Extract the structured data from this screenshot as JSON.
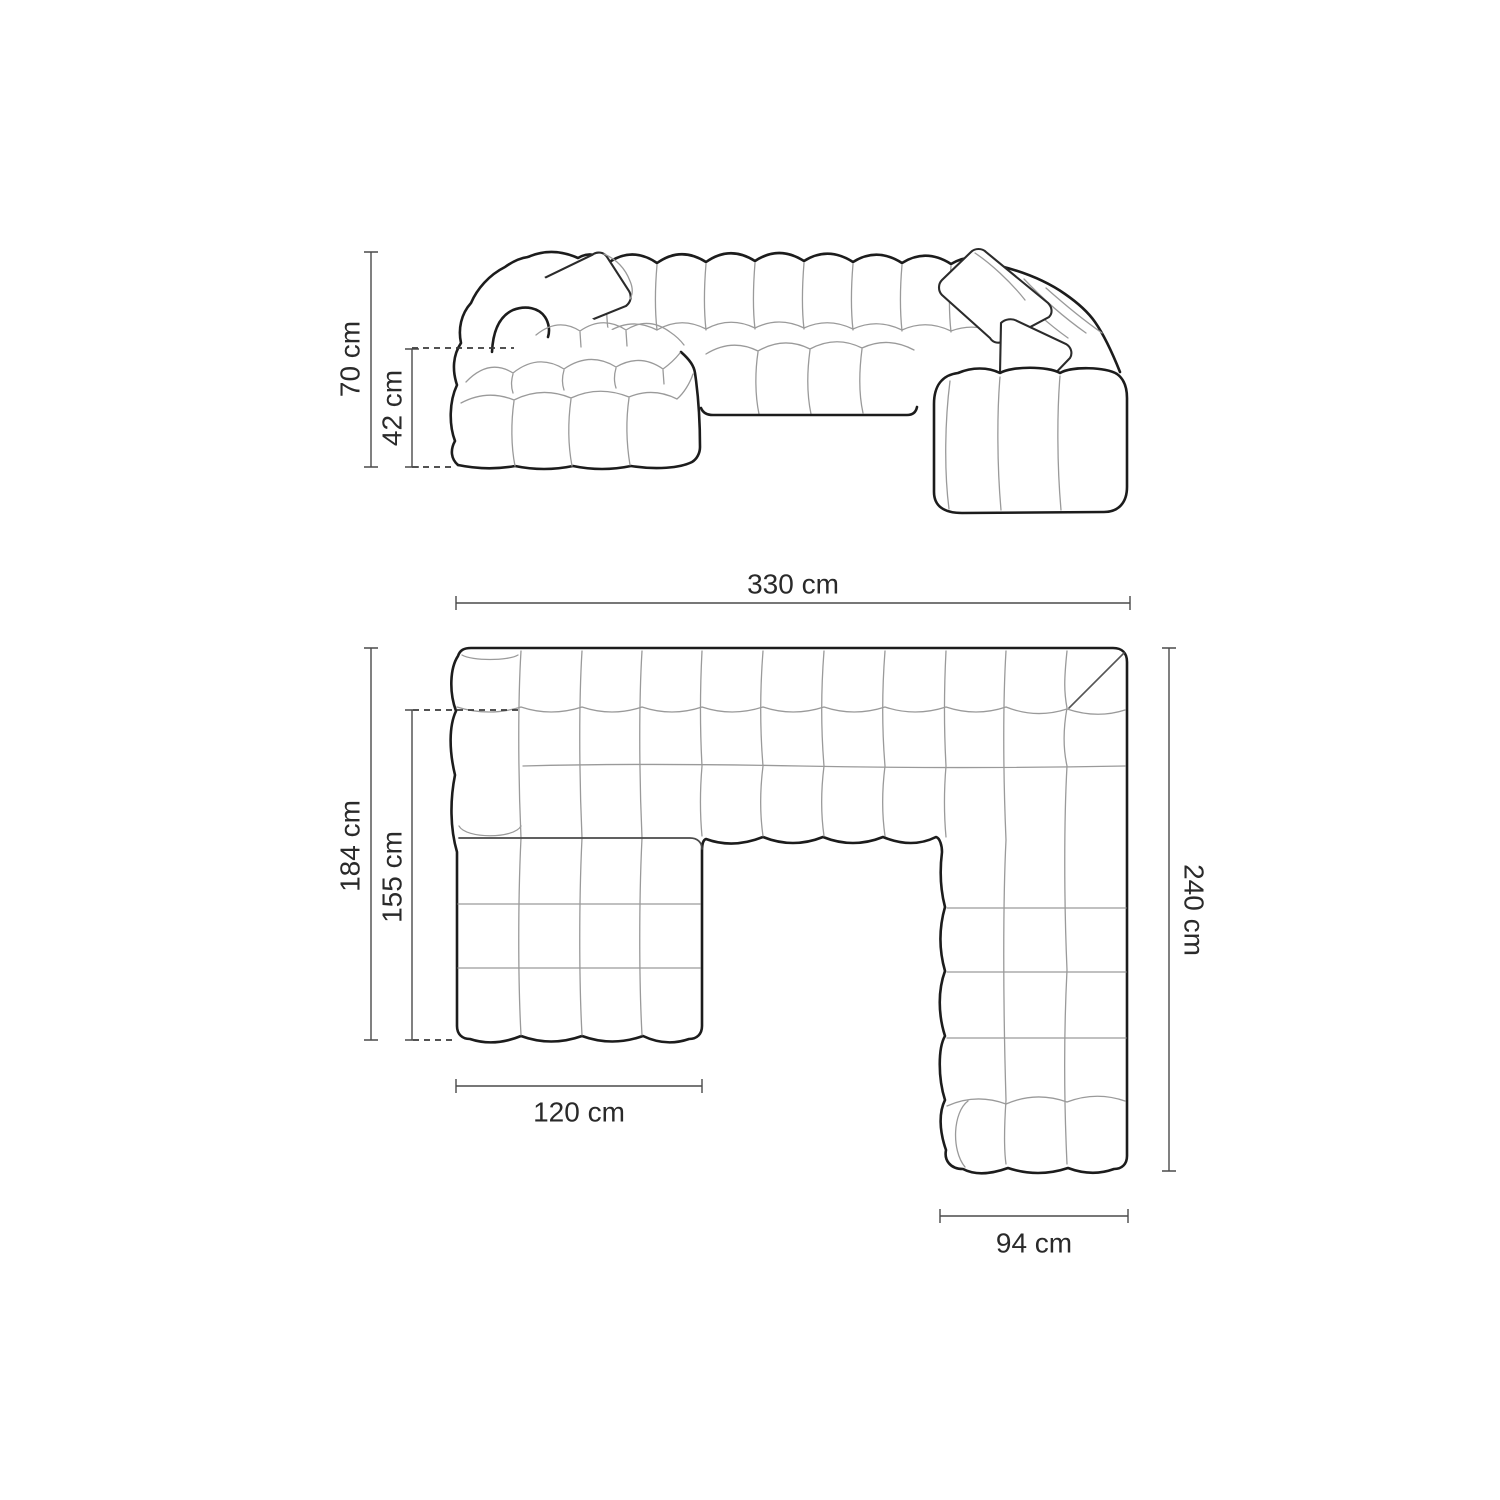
{
  "diagram": {
    "type": "furniture-dimension-drawing",
    "subject": "u-shaped-modular-sofa",
    "background_color": "#ffffff",
    "outline_color": "#1c1c1c",
    "light_line_color": "#9a9a9a",
    "dimension_line_color": "#4a4a4a",
    "text_color": "#2a2a2a",
    "dimensions": {
      "elevation": [
        {
          "id": "overall-height",
          "label": "70 cm"
        },
        {
          "id": "seat-height",
          "label": "42 cm"
        }
      ],
      "plan": [
        {
          "id": "overall-width",
          "label": "330 cm"
        },
        {
          "id": "left-depth",
          "label": "184 cm"
        },
        {
          "id": "chaise-length",
          "label": "155 cm"
        },
        {
          "id": "chaise-width",
          "label": "120 cm"
        },
        {
          "id": "right-depth",
          "label": "240 cm"
        },
        {
          "id": "right-arm-width",
          "label": "94 cm"
        }
      ]
    }
  }
}
